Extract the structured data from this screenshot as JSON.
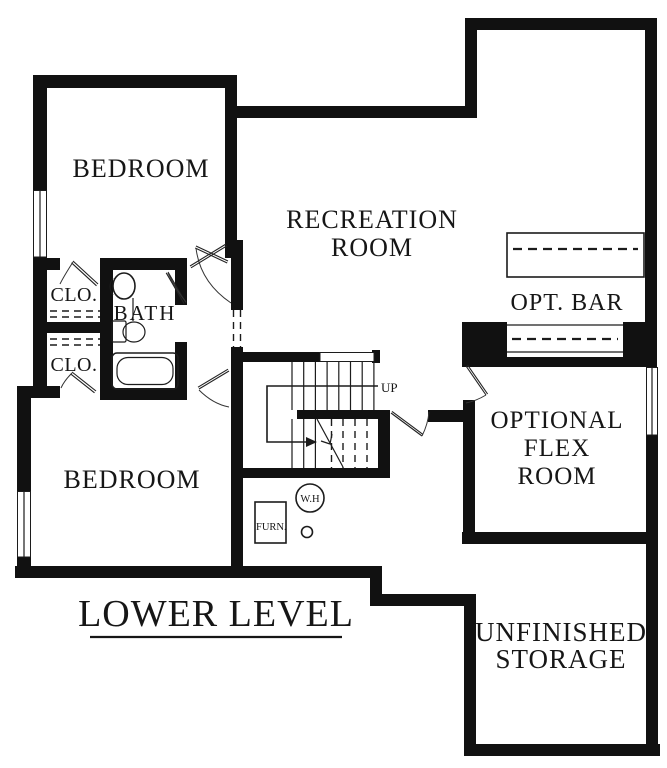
{
  "plan": {
    "title": "LOWER LEVEL",
    "labels": {
      "bedroom_upper": "BEDROOM",
      "bedroom_lower": "BEDROOM",
      "recreation_line1": "RECREATION",
      "recreation_line2": "ROOM",
      "opt_bar": "OPT. BAR",
      "flex_line1": "OPTIONAL",
      "flex_line2": "FLEX",
      "flex_line3": "ROOM",
      "storage_line1": "UNFINISHED",
      "storage_line2": "STORAGE",
      "bath": "BATH",
      "closet_upper": "CLO.",
      "closet_lower": "CLO.",
      "stairs_direction": "UP",
      "water_heater": "W.H",
      "furnace": "FURN."
    },
    "colors": {
      "wall": "#111111",
      "text": "#161616",
      "background": "#ffffff"
    }
  }
}
